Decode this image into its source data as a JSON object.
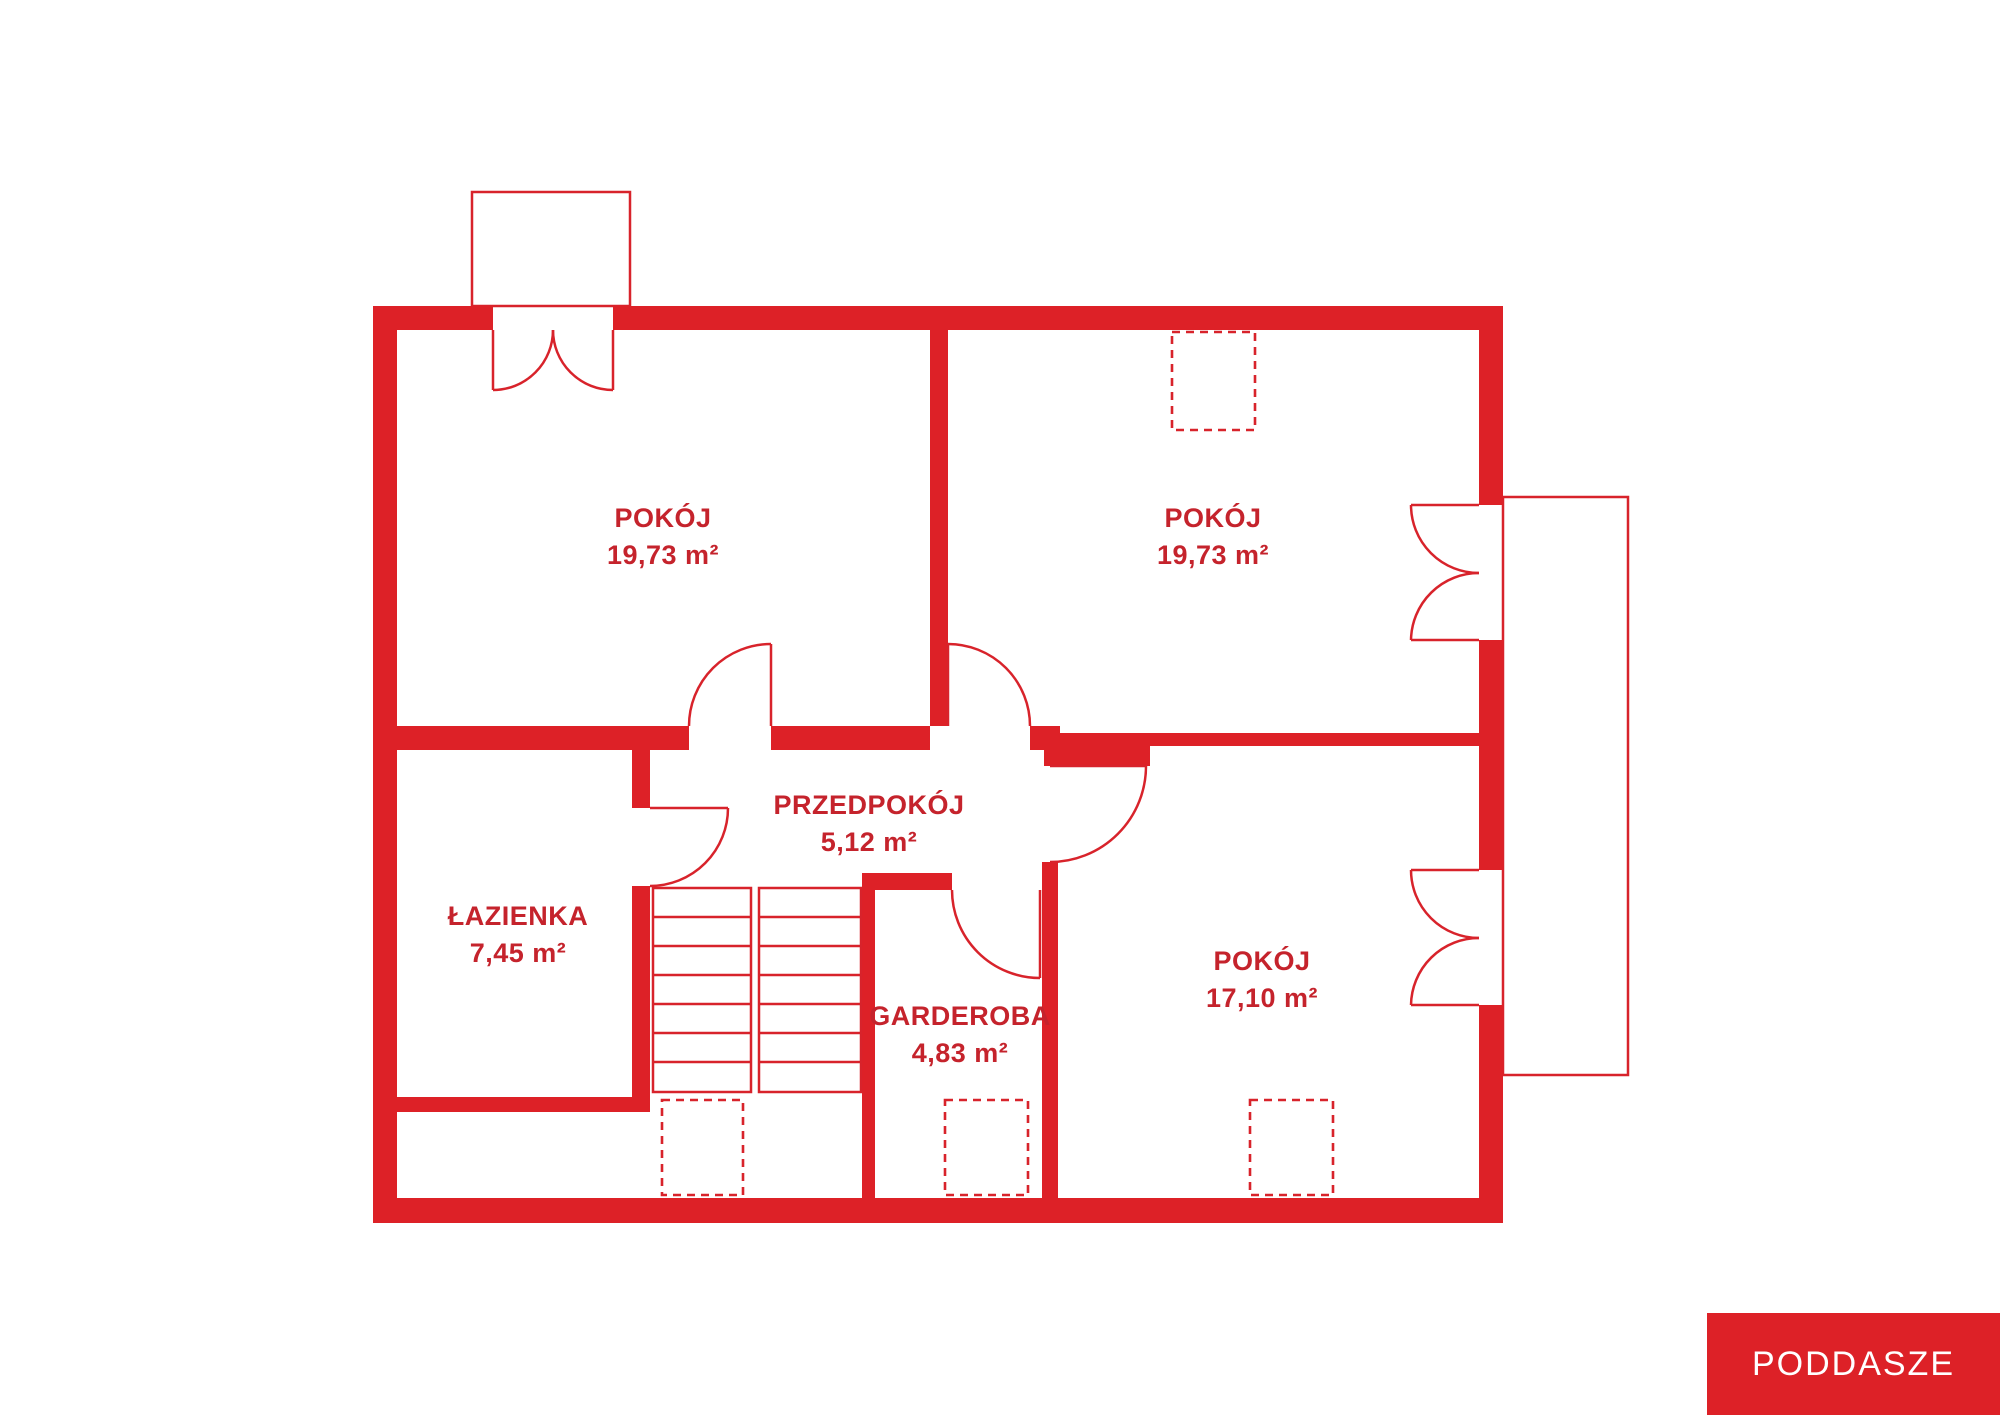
{
  "floor": {
    "badge_label": "PODDASZE"
  },
  "colors": {
    "wall_red": "#dd2127",
    "line_red": "#d8232b",
    "text_red": "#c5232c",
    "background": "#ffffff",
    "badge_text": "#ffffff"
  },
  "rooms": [
    {
      "id": "room-top-left",
      "name": "POKÓJ",
      "area": "19,73 m²"
    },
    {
      "id": "room-top-right",
      "name": "POKÓJ",
      "area": "19,73 m²"
    },
    {
      "id": "hallway",
      "name": "PRZEDPOKÓJ",
      "area": "5,12 m²"
    },
    {
      "id": "bathroom",
      "name": "ŁAZIENKA",
      "area": "7,45 m²"
    },
    {
      "id": "wardrobe",
      "name": "GARDEROBA",
      "area": "4,83 m²"
    },
    {
      "id": "room-right",
      "name": "POKÓJ",
      "area": "17,10 m²"
    }
  ]
}
